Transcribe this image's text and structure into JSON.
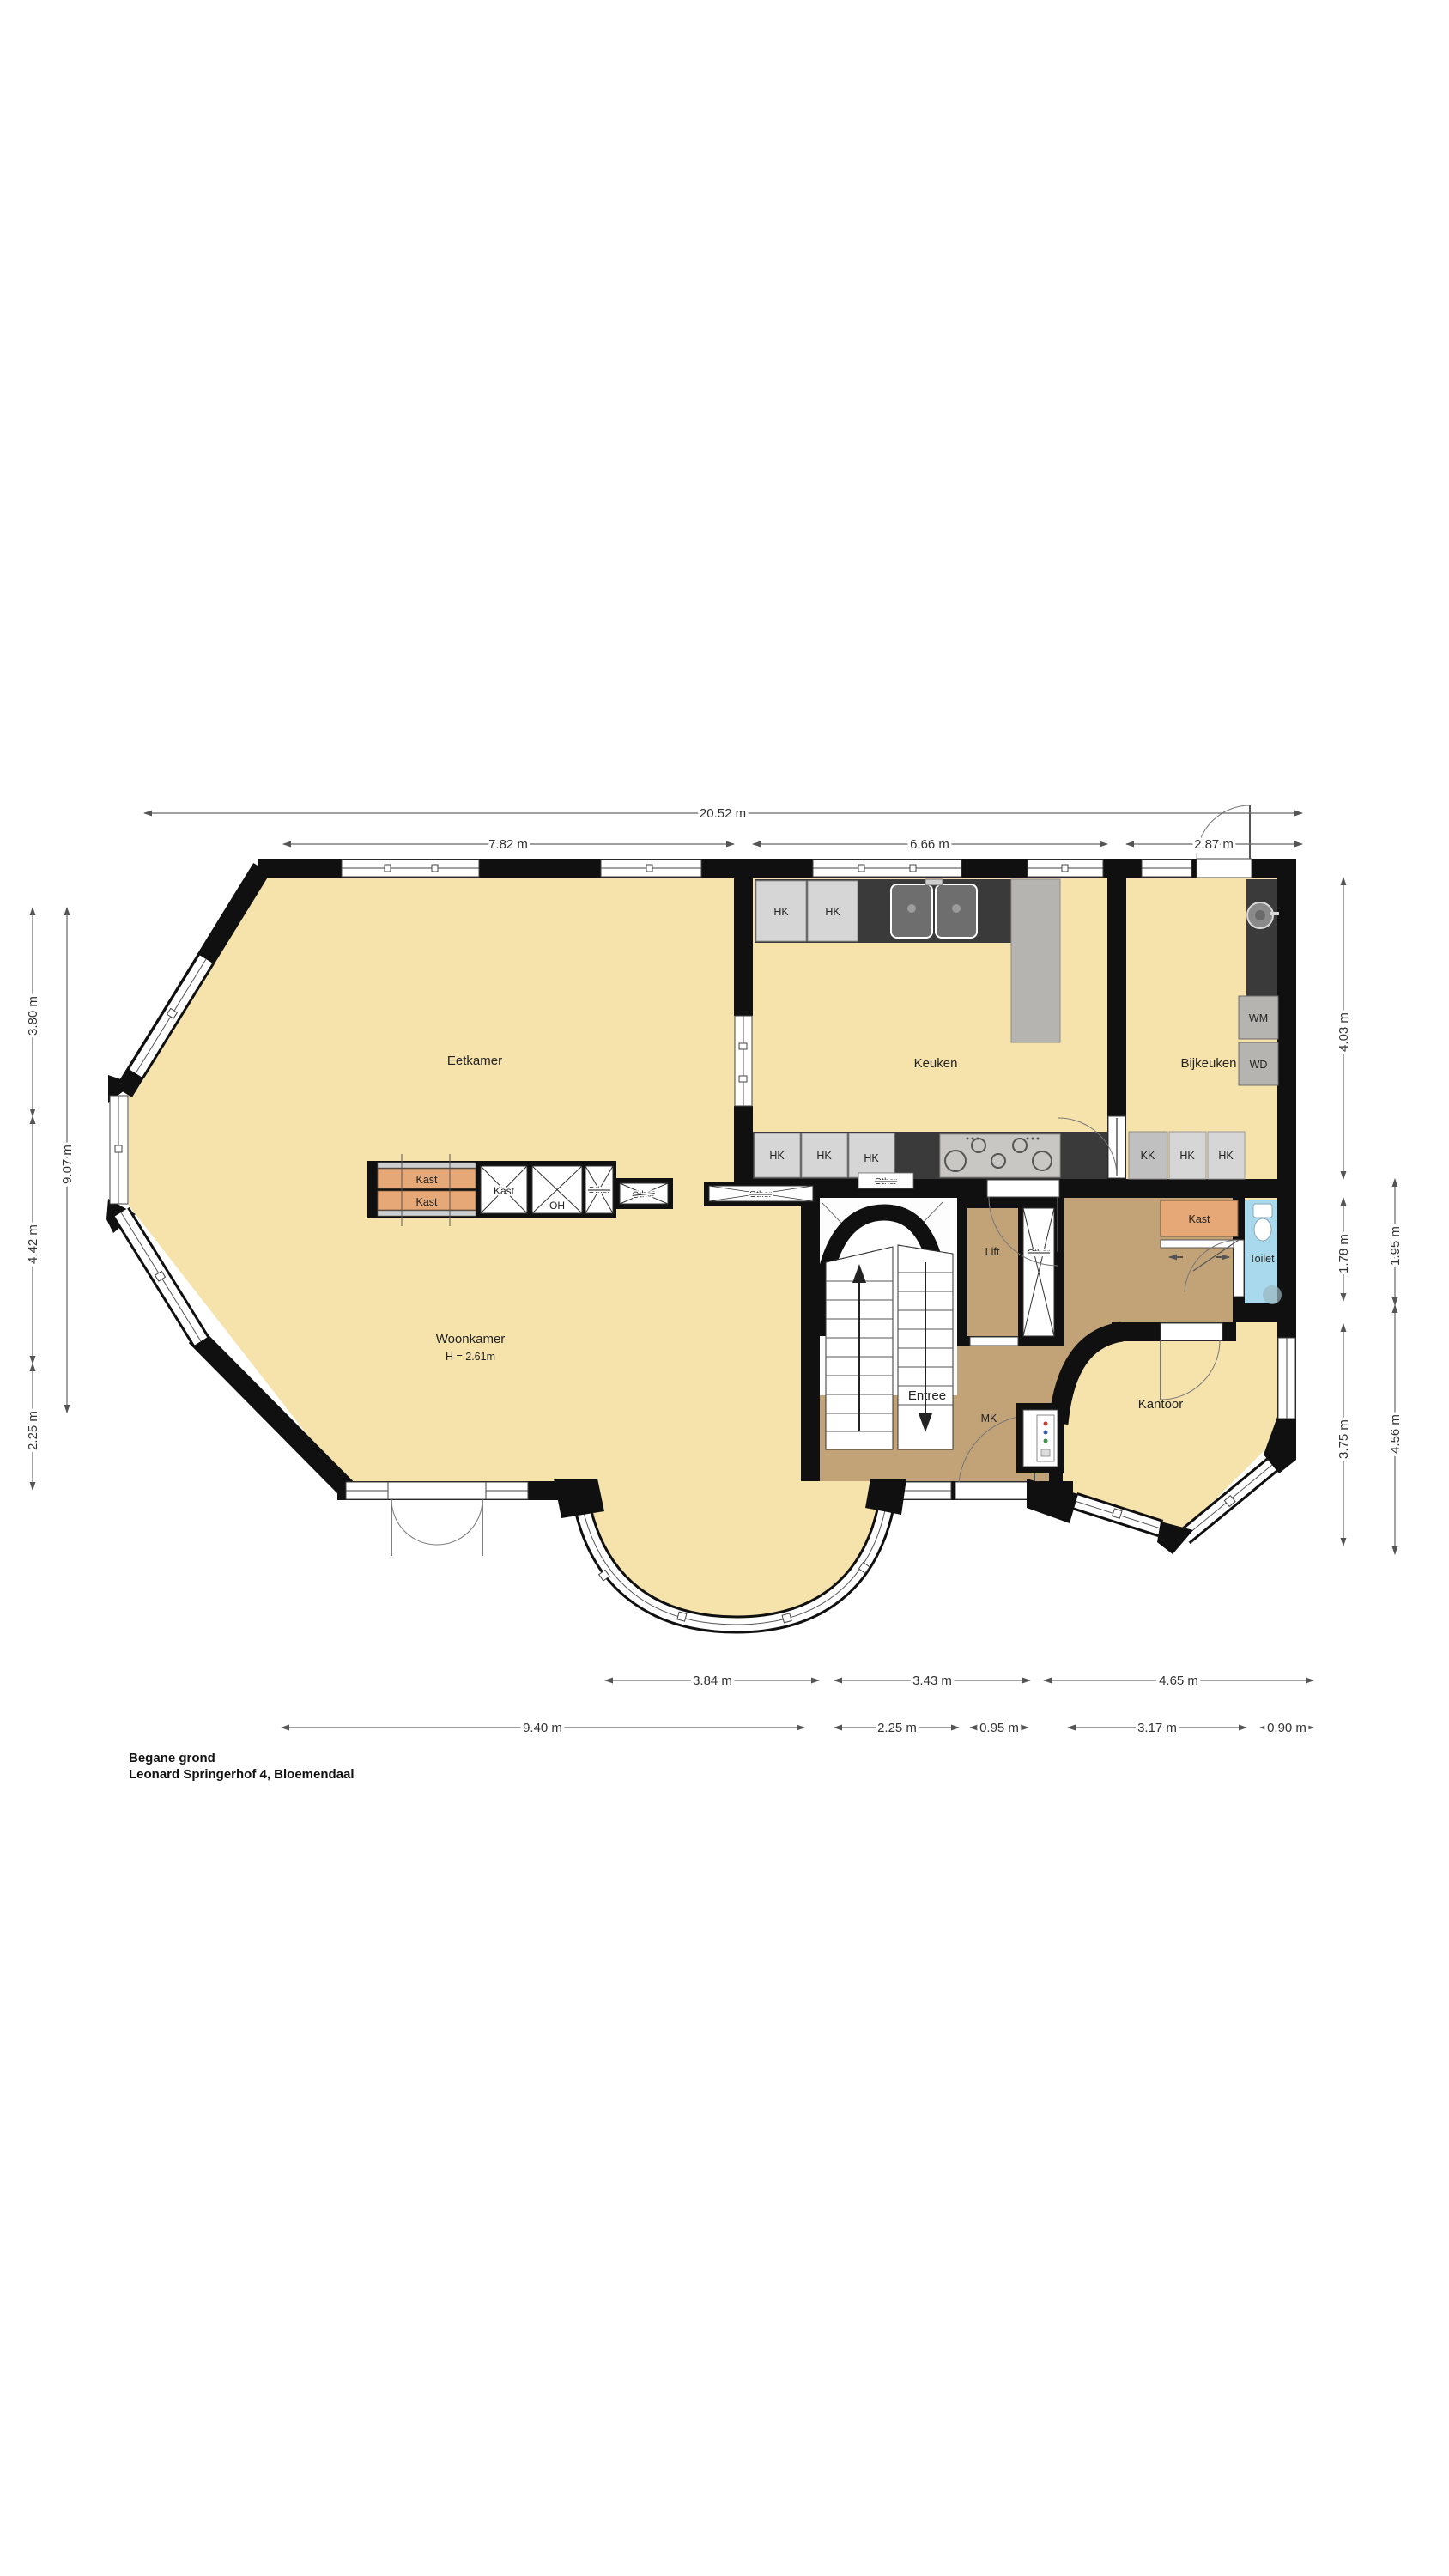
{
  "title": {
    "floor": "Begane grond",
    "address": "Leonard Springerhof 4, Bloemendaal"
  },
  "rooms": {
    "eetkamer": "Eetkamer",
    "keuken": "Keuken",
    "bijkeuken": "Bijkeuken",
    "woonkamer": "Woonkamer",
    "woonkamer_height": "H = 2.61m",
    "entree": "Entree",
    "kantoor": "Kantoor",
    "lift": "Lift",
    "toilet": "Toilet"
  },
  "labels": {
    "hk": "HK",
    "kk": "KK",
    "wm": "WM",
    "wd": "WD",
    "kast": "Kast",
    "oh": "OH",
    "other": "Other",
    "mk": "MK"
  },
  "dimensions": {
    "top_total": "20.52 m",
    "top_segments": [
      "7.82 m",
      "6.66 m",
      "2.87 m"
    ],
    "left": [
      "3.80 m",
      "9.07 m",
      "4.42 m",
      "2.25 m"
    ],
    "right": [
      "4.03 m",
      "1.78 m",
      "1.95 m",
      "4.56 m",
      "3.75 m"
    ],
    "bottom_row1": [
      "3.84 m",
      "3.43 m",
      "4.65 m"
    ],
    "bottom_row2": [
      "9.40 m",
      "2.25 m",
      "0.95 m",
      "3.17 m",
      "0.90 m"
    ]
  },
  "colors": {
    "floor_yellow": "#F6E3AC",
    "floor_brown": "#C2A277",
    "closet_orange": "#E7A878",
    "toilet_blue": "#A9D9EC",
    "counter_dark": "#3A3A3A",
    "cabinet_gray": "#D6D6D6",
    "appliance_gray": "#B6B4B0",
    "wall_black": "#101010"
  }
}
